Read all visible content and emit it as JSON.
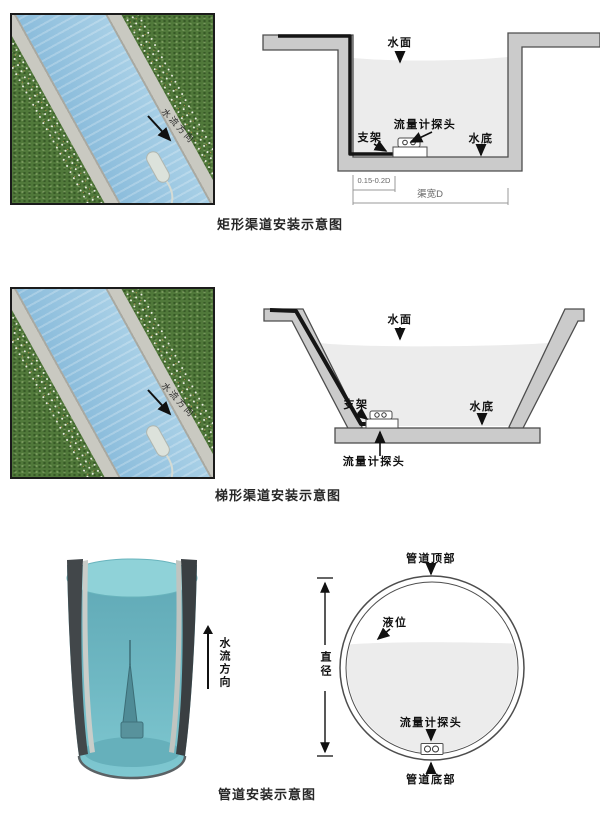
{
  "colors": {
    "outline": "#4d4d4d",
    "wall_fill": "#cbcbcb",
    "diagram_water": "#ececec",
    "grass": "#50783a",
    "photo_water": "#9cc6df",
    "concrete": "#c9c9c1",
    "pipe_water": "#7fc8d1",
    "label_text": "#111111"
  },
  "rect": {
    "caption": "矩形渠道安装示意图",
    "photo": {
      "flow_label": "水流方向"
    },
    "diagram": {
      "water_surface": "水面",
      "probe": "流量计探头",
      "bracket": "支架",
      "water_bottom": "水底",
      "dim_offset": "0.15-0.2D",
      "dim_width": "渠宽D"
    }
  },
  "trap": {
    "caption": "梯形渠道安装示意图",
    "photo": {
      "flow_label": "水流方向"
    },
    "diagram": {
      "water_surface": "水面",
      "bracket": "支架",
      "water_bottom": "水底",
      "probe": "流量计探头"
    }
  },
  "pipe": {
    "caption": "管道安装示意图",
    "photo": {
      "flow_label": "水流方向"
    },
    "diagram": {
      "pipe_top": "管道顶部",
      "level": "液位",
      "diameter": "直径",
      "probe": "流量计探头",
      "pipe_bottom": "管道底部"
    }
  }
}
